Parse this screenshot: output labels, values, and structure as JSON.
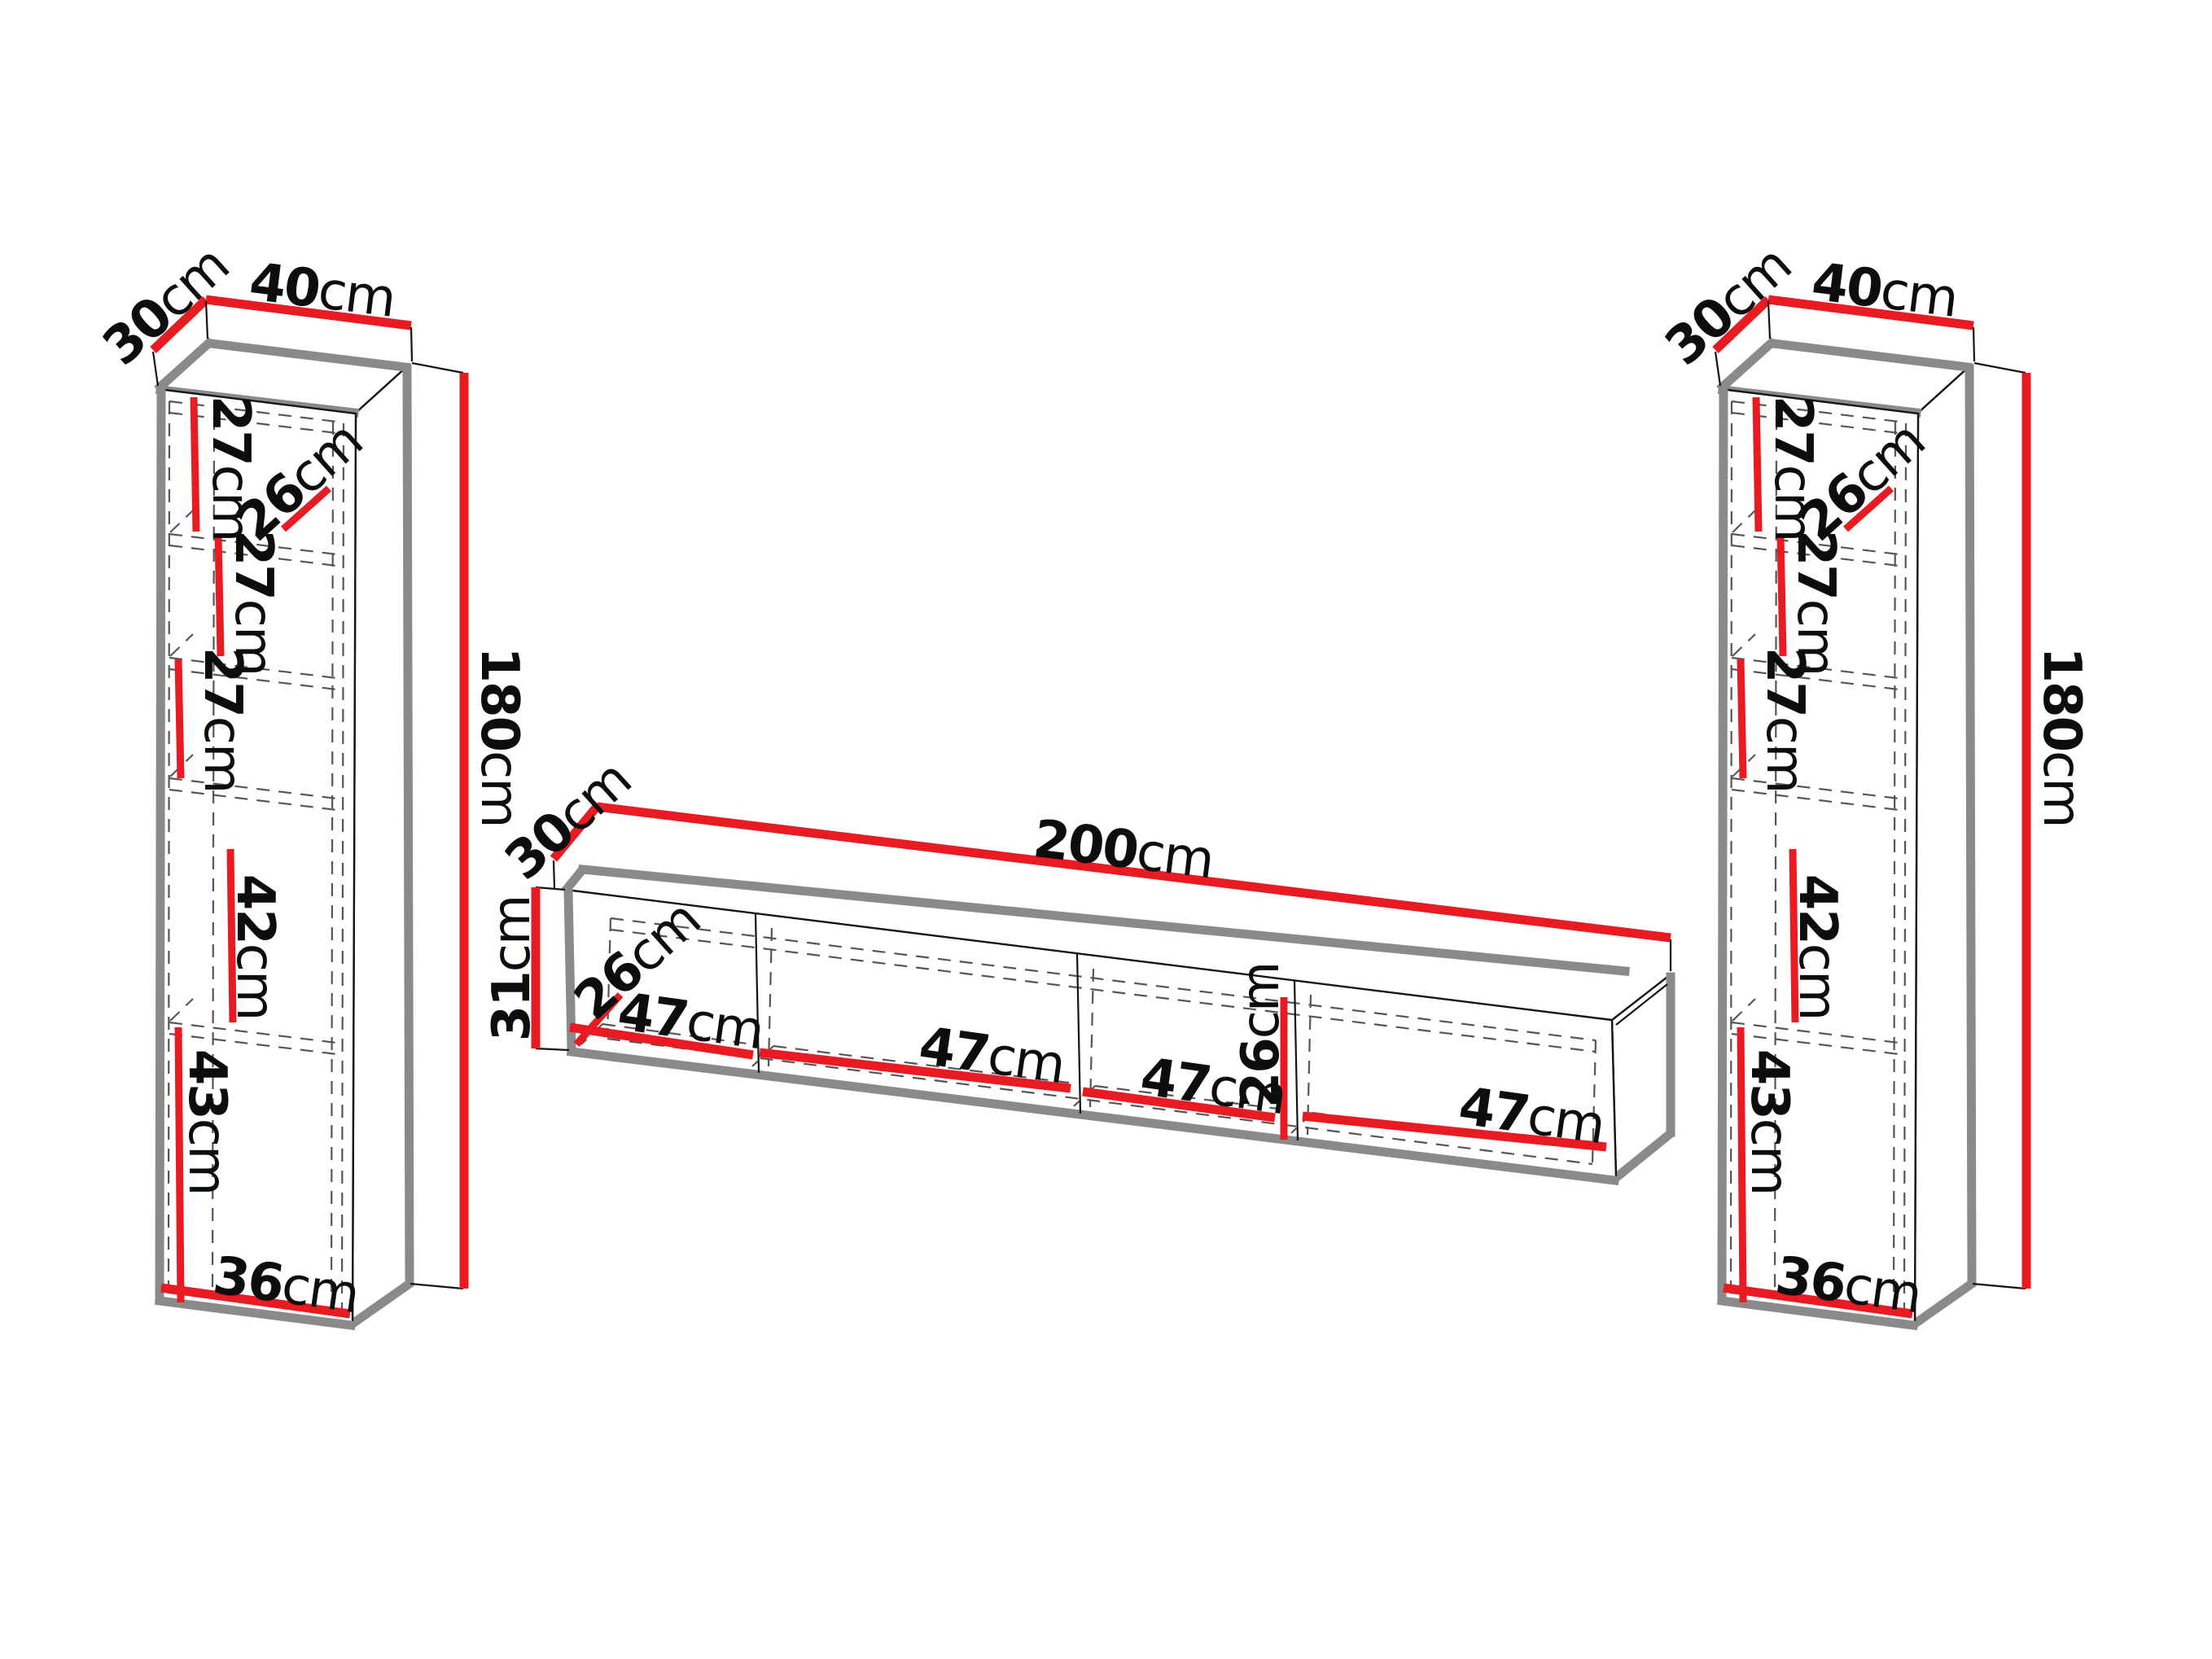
{
  "page": {
    "background": "#ffffff"
  },
  "colors": {
    "dimension_red": "#e81b22",
    "outline_black": "#141414",
    "shadow_gray": "#8a8a8a",
    "dash_gray": "#565656",
    "label_color": "#0d0d0d"
  },
  "left_cabinet": {
    "depth": {
      "value": "30",
      "unit": "cm"
    },
    "width": {
      "value": "40",
      "unit": "cm"
    },
    "height": {
      "value": "180",
      "unit": "cm"
    },
    "shelf_dims": [
      {
        "value": "27",
        "unit": "cm"
      },
      {
        "value": "26",
        "unit": "cm"
      },
      {
        "value": "27",
        "unit": "cm"
      },
      {
        "value": "27",
        "unit": "cm"
      },
      {
        "value": "42",
        "unit": "cm"
      },
      {
        "value": "43",
        "unit": "cm"
      }
    ],
    "bottom_width": {
      "value": "36",
      "unit": "cm"
    }
  },
  "tv_stand": {
    "depth": {
      "value": "30",
      "unit": "cm"
    },
    "width": {
      "value": "200",
      "unit": "cm"
    },
    "height": {
      "value": "31",
      "unit": "cm"
    },
    "inner_depth": {
      "value": "26",
      "unit": "cm"
    },
    "inner_height": {
      "value": "26",
      "unit": "cm"
    },
    "sections": [
      {
        "value": "47",
        "unit": "cm"
      },
      {
        "value": "47",
        "unit": "cm"
      },
      {
        "value": "47",
        "unit": "cm"
      },
      {
        "value": "47",
        "unit": "cm"
      }
    ]
  },
  "right_cabinet": {
    "depth": {
      "value": "30",
      "unit": "cm"
    },
    "width": {
      "value": "40",
      "unit": "cm"
    },
    "height": {
      "value": "180",
      "unit": "cm"
    },
    "shelf_dims": [
      {
        "value": "27",
        "unit": "cm"
      },
      {
        "value": "26",
        "unit": "cm"
      },
      {
        "value": "27",
        "unit": "cm"
      },
      {
        "value": "27",
        "unit": "cm"
      },
      {
        "value": "42",
        "unit": "cm"
      },
      {
        "value": "43",
        "unit": "cm"
      }
    ],
    "bottom_width": {
      "value": "36",
      "unit": "cm"
    }
  }
}
